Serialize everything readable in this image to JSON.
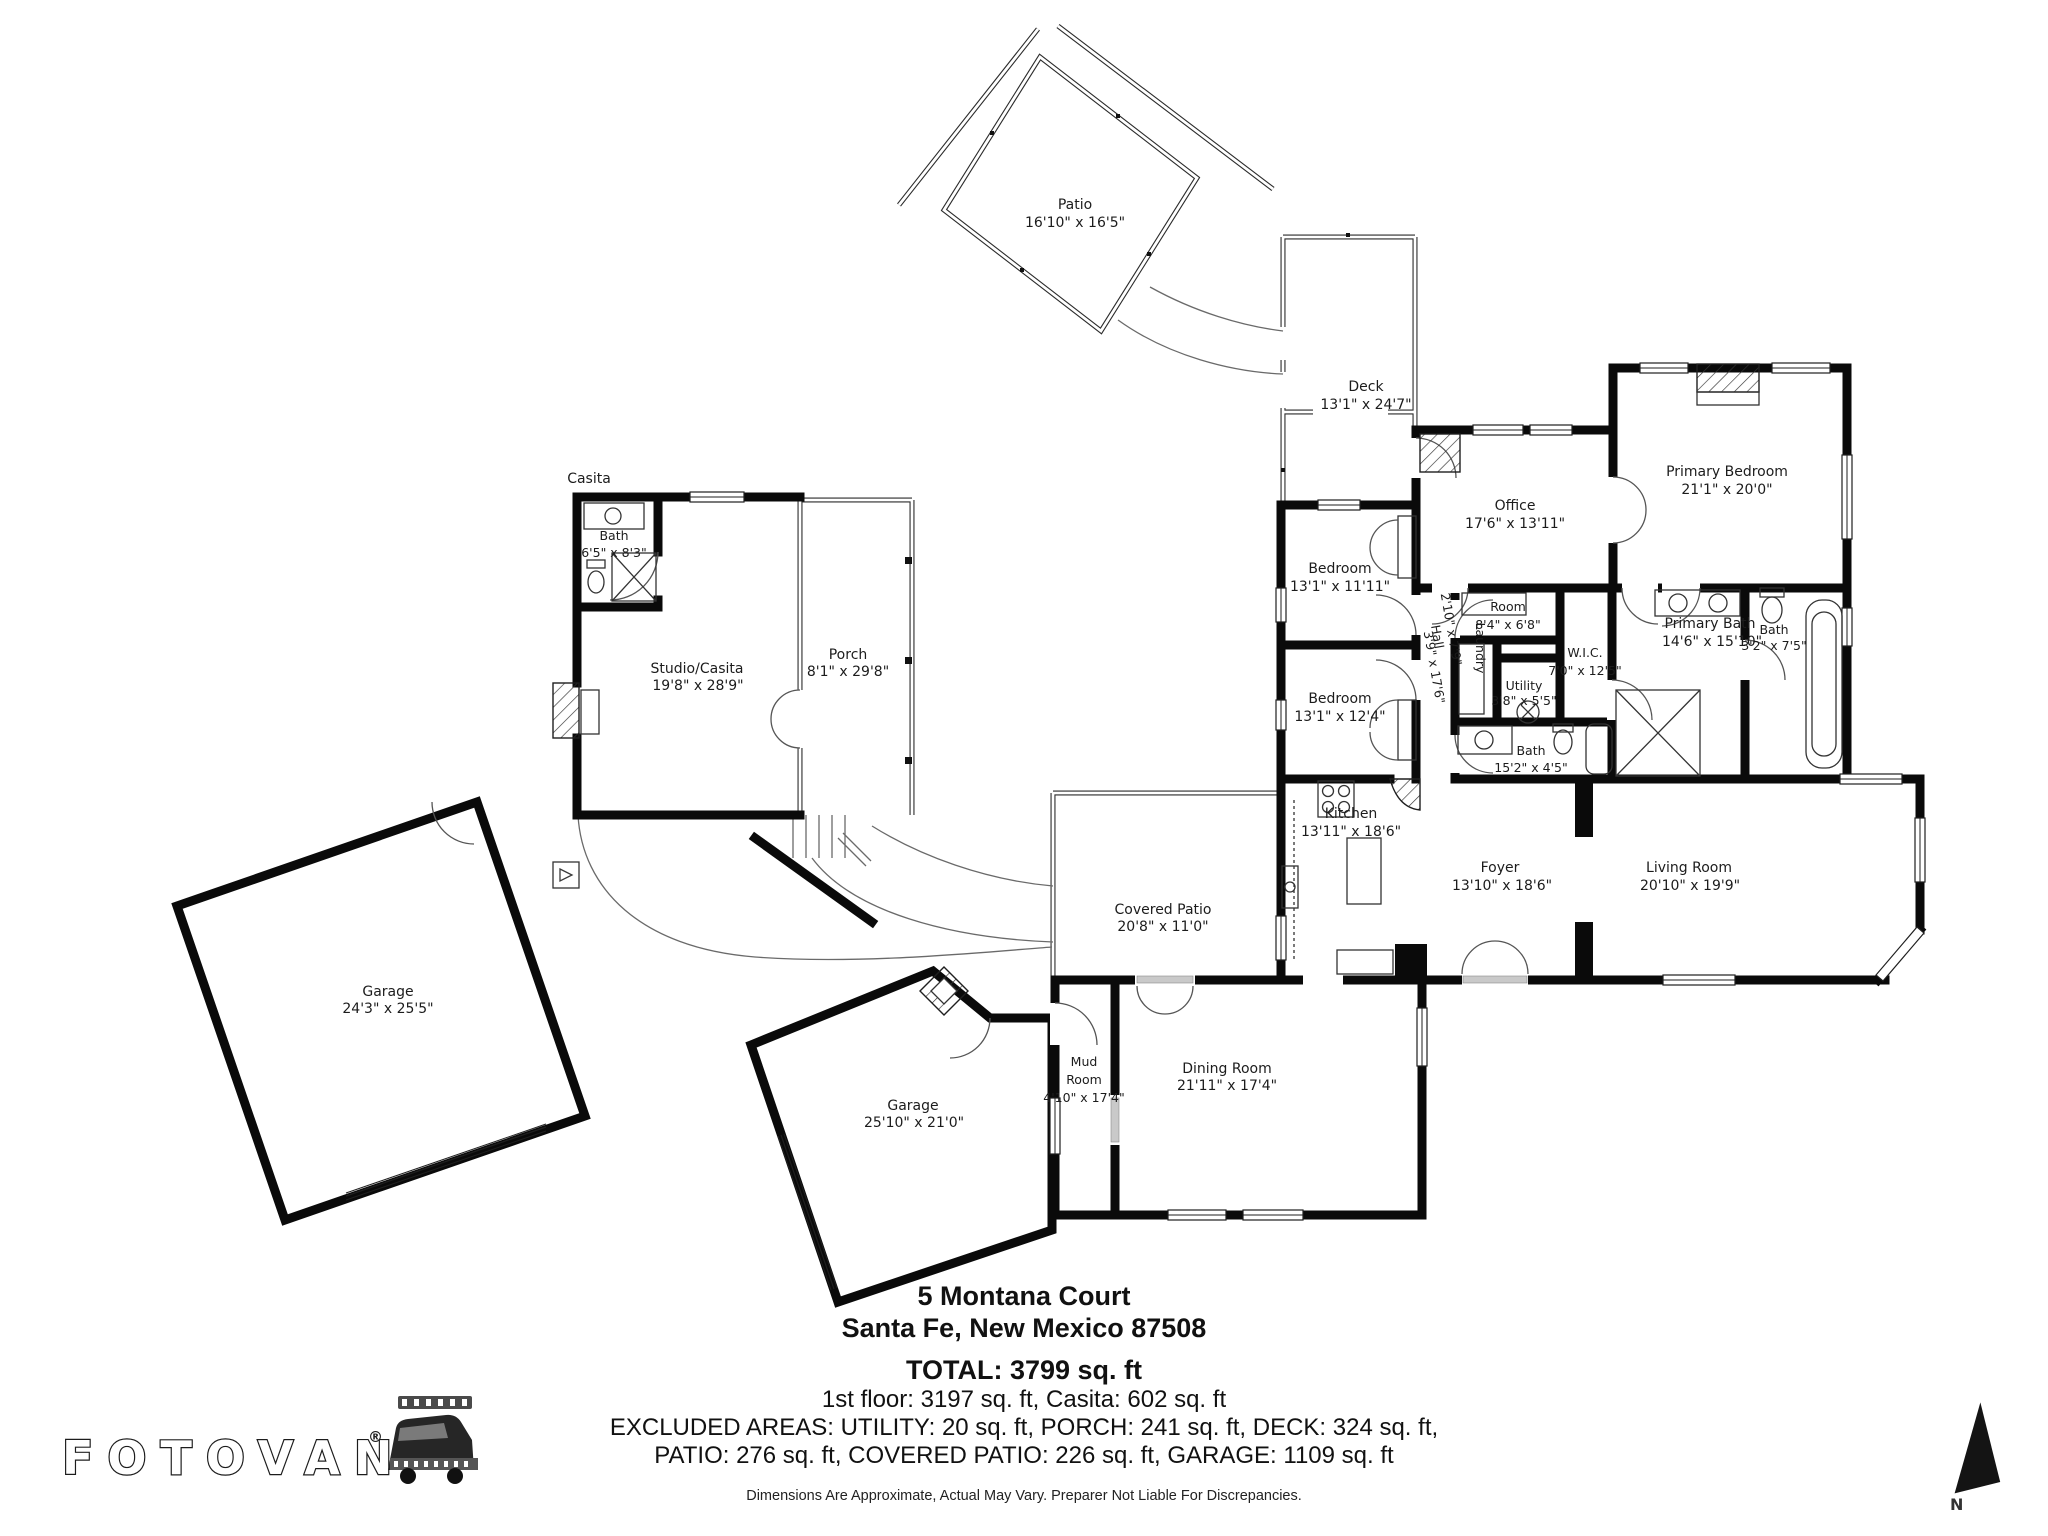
{
  "rooms": {
    "patio": {
      "name": "Patio",
      "dims": "16'10\" x 16'5\""
    },
    "deck": {
      "name": "Deck",
      "dims": "13'1\" x 24'7\""
    },
    "office": {
      "name": "Office",
      "dims": "17'6\" x 13'11\""
    },
    "primary_bedroom": {
      "name": "Primary Bedroom",
      "dims": "21'1\" x 20'0\""
    },
    "bedroom1": {
      "name": "Bedroom",
      "dims": "13'1\" x 11'11\""
    },
    "bedroom2": {
      "name": "Bedroom",
      "dims": "13'1\" x 12'4\""
    },
    "room": {
      "name": "Room",
      "dims": "8'4\" x 6'8\""
    },
    "wic": {
      "name": "W.I.C.",
      "dims": "7'0\" x 12'5\""
    },
    "utility": {
      "name": "Utility",
      "dims": "3'8\" x 5'5\""
    },
    "laundry": {
      "name": "Laundry"
    },
    "hall": {
      "name": "Hall",
      "dims": "2'10\" x 7'9\""
    },
    "hall2": {
      "dims": "3'9\" x 17'6\""
    },
    "bath_main": {
      "name": "Bath",
      "dims": "15'2\" x 4'5\""
    },
    "primary_bath": {
      "name": "Primary Bath",
      "dims": "14'6\" x 15'10\""
    },
    "bath_small": {
      "name": "Bath",
      "dims": "3'2\" x 7'5\""
    },
    "kitchen": {
      "name": "Kitchen",
      "dims": "13'11\" x 18'6\""
    },
    "foyer": {
      "name": "Foyer",
      "dims": "13'10\" x 18'6\""
    },
    "living_room": {
      "name": "Living Room",
      "dims": "20'10\" x 19'9\""
    },
    "covered_patio": {
      "name": "Covered Patio",
      "dims": "20'8\" x 11'0\""
    },
    "mud_room": {
      "name_line1": "Mud",
      "name_line2": "Room",
      "dims": "4'10\" x 17'4\""
    },
    "dining_room": {
      "name": "Dining Room",
      "dims": "21'11\" x 17'4\""
    },
    "garage_angled": {
      "name": "Garage",
      "dims": "25'10\" x 21'0\""
    },
    "garage_left": {
      "name": "Garage",
      "dims": "24'3\" x 25'5\""
    },
    "studio_casita": {
      "name": "Studio/Casita",
      "dims": "19'8\" x 28'9\""
    },
    "casita_bath": {
      "name": "Bath",
      "dims": "6'5\" x 8'3\""
    },
    "porch": {
      "name": "Porch",
      "dims": "8'1\" x 29'8\""
    }
  },
  "annotations": {
    "casita_area": "Casita"
  },
  "footer": {
    "address_line1": "5 Montana Court",
    "address_line2": "Santa Fe, New Mexico 87508",
    "total": "TOTAL: 3799 sq. ft",
    "floors": "1st floor: 3197 sq. ft, Casita: 602 sq. ft",
    "excluded_line1": "EXCLUDED AREAS: UTILITY: 20 sq. ft, PORCH: 241 sq. ft, DECK: 324 sq. ft,",
    "excluded_line2": "PATIO: 276 sq. ft, COVERED PATIO: 226 sq. ft, GARAGE: 1109 sq. ft",
    "disclaimer": "Dimensions Are Approximate, Actual May Vary. Preparer Not Liable For Discrepancies."
  },
  "branding": {
    "logo_text": "FOTOVAN",
    "registered_mark": "®"
  },
  "compass": {
    "label": "N"
  },
  "colors": {
    "walls": "#0a0a0a",
    "background": "#ffffff",
    "text": "#1c1c1c"
  }
}
